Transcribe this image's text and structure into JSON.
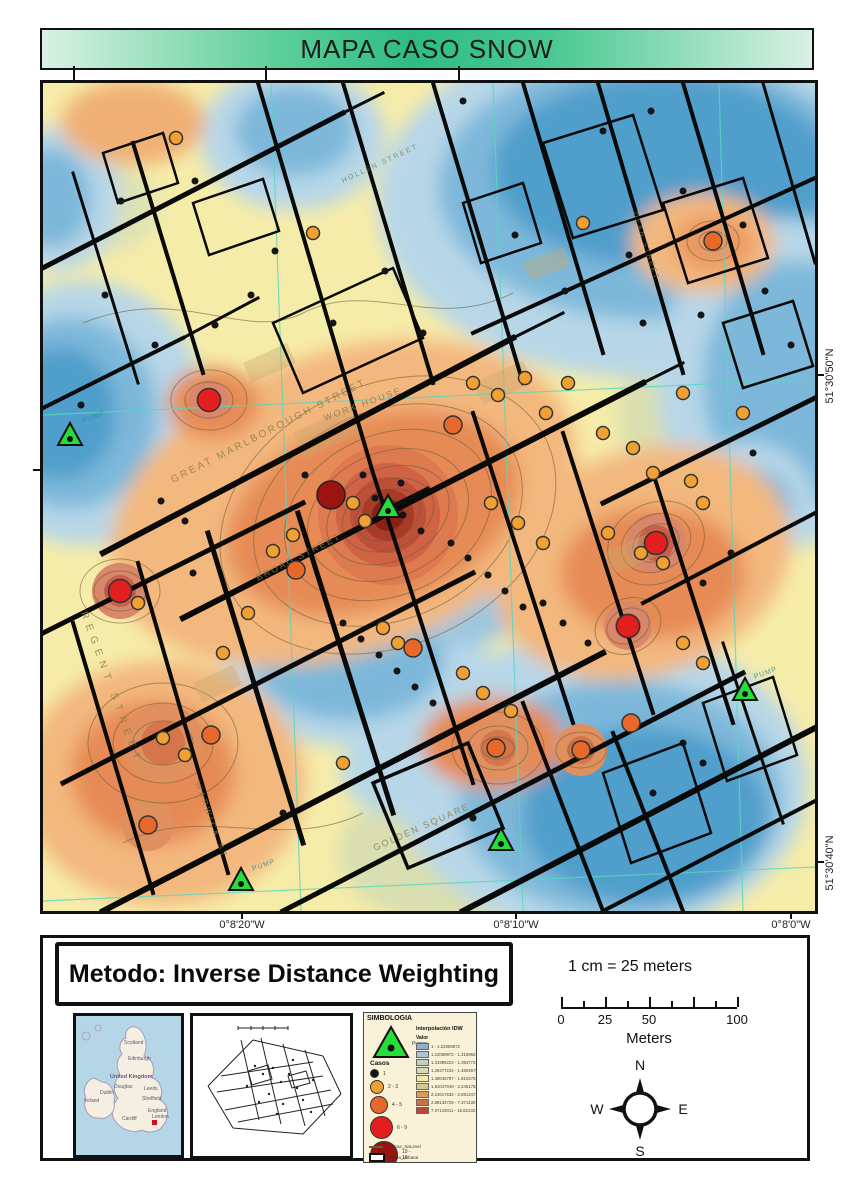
{
  "title": "MAPA CASO SNOW",
  "map": {
    "coordinates": {
      "lon": [
        "0°8'20\"W",
        "0°8'10\"W",
        "0°8'0\"W"
      ],
      "lat": [
        "51°30'50\"N",
        "51°30'40\"N"
      ]
    },
    "street_labels": {
      "marlborough": "GREAT MARLBOROUGH STREET",
      "broad": "BROAD STREET",
      "workhouse": "WORK HOUSE",
      "golden": "GOLDEN SQUARE",
      "regent": "REGENT STREET",
      "warwick": "WARWICK ST",
      "hollen": "HOLLEN STREET",
      "dean": "DEAN STREET",
      "pump1": "PUMP",
      "pump2": "PUMP",
      "pump3": "PUMP"
    },
    "marker_classes": {
      "c1": {
        "r": 3.5,
        "fill": "#151515",
        "stroke": "none"
      },
      "c2": {
        "r": 6.5,
        "fill": "#f0a132",
        "stroke": "#333"
      },
      "c3": {
        "r": 9,
        "fill": "#e8682a",
        "stroke": "#333"
      },
      "c4": {
        "r": 11.5,
        "fill": "#e31e1e",
        "stroke": "#333"
      },
      "c5": {
        "r": 14,
        "fill": "#9c1410",
        "stroke": "#222"
      }
    },
    "markers": {
      "pumps": [
        [
          27,
          353
        ],
        [
          345,
          425
        ],
        [
          198,
          798
        ],
        [
          458,
          758
        ],
        [
          702,
          608
        ]
      ],
      "cases": [
        [
          288,
          412,
          "c5"
        ],
        [
          77,
          508,
          "c4"
        ],
        [
          166,
          317,
          "c4"
        ],
        [
          613,
          460,
          "c4"
        ],
        [
          585,
          543,
          "c4"
        ],
        [
          253,
          487,
          "c3"
        ],
        [
          453,
          665,
          "c3"
        ],
        [
          538,
          667,
          "c3"
        ],
        [
          168,
          652,
          "c3"
        ],
        [
          410,
          342,
          "c3"
        ],
        [
          370,
          565,
          "c3"
        ],
        [
          588,
          640,
          "c3"
        ],
        [
          670,
          158,
          "c3"
        ],
        [
          105,
          742,
          "c3"
        ],
        [
          133,
          55,
          "c2"
        ],
        [
          270,
          150,
          "c2"
        ],
        [
          430,
          300,
          "c2"
        ],
        [
          455,
          312,
          "c2"
        ],
        [
          482,
          295,
          "c2"
        ],
        [
          503,
          330,
          "c2"
        ],
        [
          560,
          350,
          "c2"
        ],
        [
          590,
          365,
          "c2"
        ],
        [
          610,
          390,
          "c2"
        ],
        [
          648,
          398,
          "c2"
        ],
        [
          660,
          420,
          "c2"
        ],
        [
          310,
          420,
          "c2"
        ],
        [
          322,
          438,
          "c2"
        ],
        [
          250,
          452,
          "c2"
        ],
        [
          230,
          468,
          "c2"
        ],
        [
          205,
          530,
          "c2"
        ],
        [
          340,
          545,
          "c2"
        ],
        [
          355,
          560,
          "c2"
        ],
        [
          420,
          590,
          "c2"
        ],
        [
          440,
          610,
          "c2"
        ],
        [
          468,
          628,
          "c2"
        ],
        [
          300,
          680,
          "c2"
        ],
        [
          180,
          570,
          "c2"
        ],
        [
          95,
          520,
          "c2"
        ],
        [
          640,
          310,
          "c2"
        ],
        [
          700,
          330,
          "c2"
        ],
        [
          540,
          140,
          "c2"
        ],
        [
          448,
          420,
          "c2"
        ],
        [
          475,
          440,
          "c2"
        ],
        [
          500,
          460,
          "c2"
        ],
        [
          525,
          300,
          "c2"
        ],
        [
          565,
          450,
          "c2"
        ],
        [
          598,
          470,
          "c2"
        ],
        [
          620,
          480,
          "c2"
        ],
        [
          640,
          560,
          "c2"
        ],
        [
          660,
          580,
          "c2"
        ],
        [
          120,
          655,
          "c2"
        ],
        [
          142,
          672,
          "c2"
        ],
        [
          420,
          18,
          "c1"
        ],
        [
          560,
          48,
          "c1"
        ],
        [
          608,
          28,
          "c1"
        ],
        [
          640,
          108,
          "c1"
        ],
        [
          700,
          142,
          "c1"
        ],
        [
          78,
          118,
          "c1"
        ],
        [
          152,
          98,
          "c1"
        ],
        [
          232,
          168,
          "c1"
        ],
        [
          342,
          188,
          "c1"
        ],
        [
          472,
          152,
          "c1"
        ],
        [
          522,
          208,
          "c1"
        ],
        [
          586,
          172,
          "c1"
        ],
        [
          658,
          232,
          "c1"
        ],
        [
          722,
          208,
          "c1"
        ],
        [
          748,
          262,
          "c1"
        ],
        [
          62,
          212,
          "c1"
        ],
        [
          112,
          262,
          "c1"
        ],
        [
          38,
          322,
          "c1"
        ],
        [
          172,
          242,
          "c1"
        ],
        [
          208,
          212,
          "c1"
        ],
        [
          118,
          418,
          "c1"
        ],
        [
          142,
          438,
          "c1"
        ],
        [
          262,
          392,
          "c1"
        ],
        [
          320,
          392,
          "c1"
        ],
        [
          358,
          400,
          "c1"
        ],
        [
          300,
          540,
          "c1"
        ],
        [
          318,
          556,
          "c1"
        ],
        [
          336,
          572,
          "c1"
        ],
        [
          354,
          588,
          "c1"
        ],
        [
          372,
          604,
          "c1"
        ],
        [
          390,
          620,
          "c1"
        ],
        [
          500,
          520,
          "c1"
        ],
        [
          520,
          540,
          "c1"
        ],
        [
          545,
          560,
          "c1"
        ],
        [
          640,
          660,
          "c1"
        ],
        [
          660,
          680,
          "c1"
        ],
        [
          610,
          710,
          "c1"
        ],
        [
          430,
          735,
          "c1"
        ],
        [
          240,
          730,
          "c1"
        ],
        [
          150,
          490,
          "c1"
        ],
        [
          660,
          500,
          "c1"
        ],
        [
          688,
          470,
          "c1"
        ],
        [
          710,
          370,
          "c1"
        ],
        [
          600,
          240,
          "c1"
        ],
        [
          380,
          250,
          "c1"
        ],
        [
          290,
          240,
          "c1"
        ],
        [
          408,
          460,
          "c1"
        ],
        [
          425,
          475,
          "c1"
        ],
        [
          445,
          492,
          "c1"
        ],
        [
          462,
          508,
          "c1"
        ],
        [
          480,
          524,
          "c1"
        ],
        [
          332,
          415,
          "c1"
        ],
        [
          360,
          432,
          "c1"
        ],
        [
          378,
          448,
          "c1"
        ]
      ]
    }
  },
  "footer": {
    "method_label": "Metodo: Inverse Distance Weighting",
    "scale_text": "1 cm = 25 meters",
    "scale_bar": {
      "tick_labels": [
        "0",
        "25",
        "50",
        "100"
      ],
      "unit": "Meters"
    },
    "compass": {
      "n": "N",
      "s": "S",
      "e": "E",
      "w": "W"
    }
  },
  "legend": {
    "title": "SIMBOLOGIA",
    "pump_label": "Pumps",
    "cases_title": "Casos",
    "cases_classes": [
      {
        "label": "1",
        "color": "#151515",
        "d": 7
      },
      {
        "label": "2 - 3",
        "color": "#f0a132",
        "d": 12
      },
      {
        "label": "4 - 5",
        "color": "#e8682a",
        "d": 16
      },
      {
        "label": "6 - 9",
        "color": "#e31e1e",
        "d": 21
      },
      {
        "label": "10 - 16",
        "color": "#9c1410",
        "d": 26
      }
    ],
    "idw_title": "Interpolación IDW",
    "idw_value_label": "Valor",
    "idw_classes": [
      {
        "label": "1 - 1.22059972",
        "color": "#8cb0d8"
      },
      {
        "label": "1.22059972 - 1.31999223",
        "color": "#a9c6dd"
      },
      {
        "label": "1.31999223 - 1.39477234",
        "color": "#c7cdb8"
      },
      {
        "label": "1.39477234 - 1.48046787",
        "color": "#d6dcb0"
      },
      {
        "label": "1.48046787 - 1.81047049",
        "color": "#eeeaa8"
      },
      {
        "label": "1.81047049 - 2.24617532",
        "color": "#d5c78e"
      },
      {
        "label": "2.24617532 - 2.89134729",
        "color": "#e09a57"
      },
      {
        "label": "2.89134729 - 7.37143011",
        "color": "#cc7146"
      },
      {
        "label": "7.37143011 - 16.8213215",
        "color": "#bf4636"
      }
    ],
    "contour_label": "Contour_SnLevel",
    "urban_label": "Trama_Urbana"
  },
  "insets": {
    "uk": {
      "labels": [
        "Scotland",
        "Edinburgh",
        "United Kingdom",
        "Ireland",
        "Dublin",
        "Douglas",
        "Leeds",
        "Sheffield",
        "England",
        "Cardiff",
        "London"
      ]
    }
  }
}
